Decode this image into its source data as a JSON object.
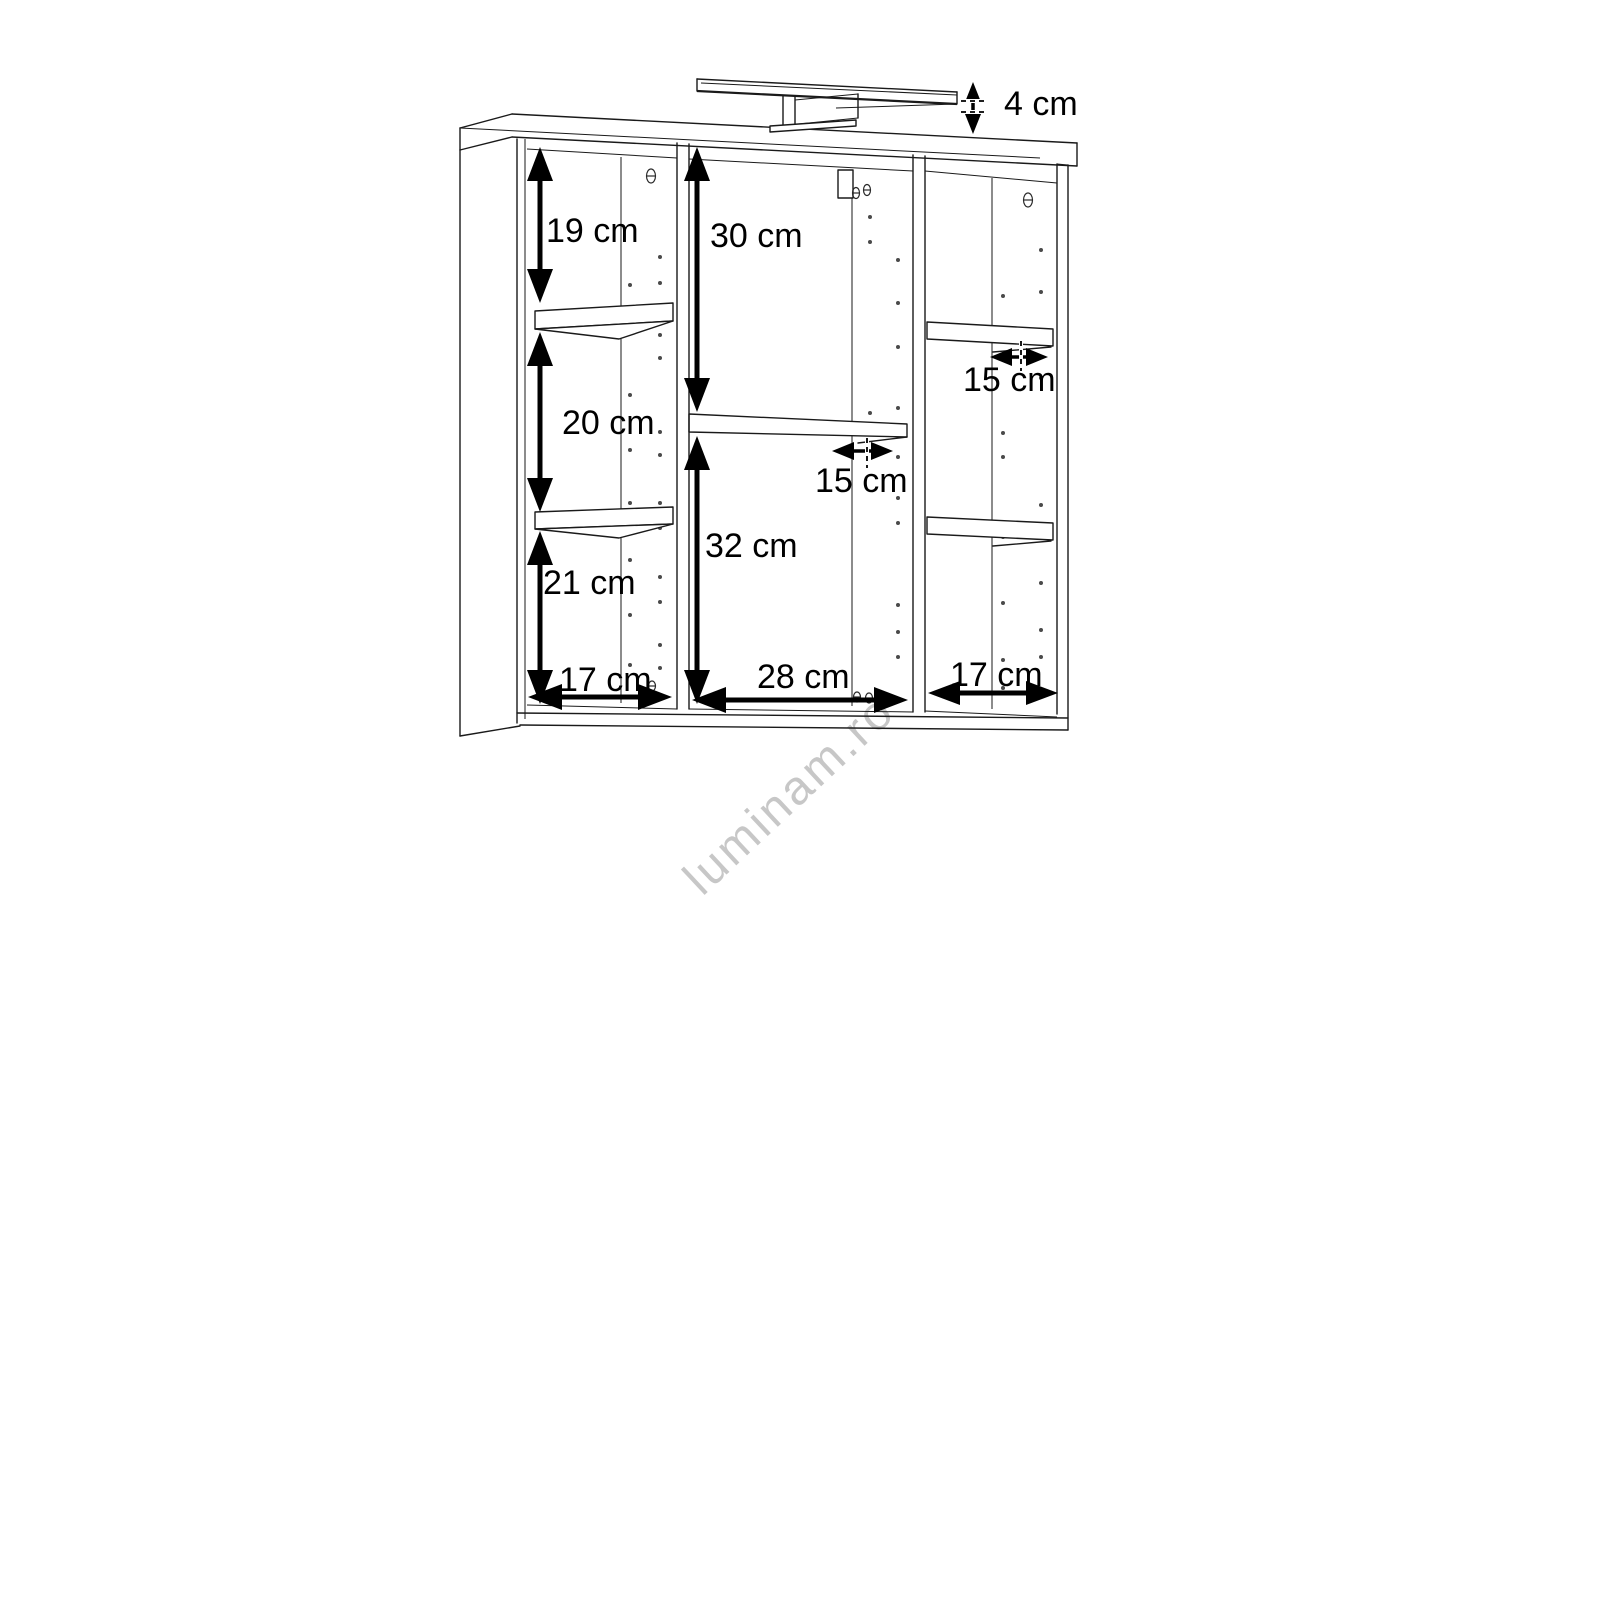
{
  "diagram": {
    "type": "furniture-dimension-drawing",
    "watermark": "luminam.ro",
    "unit": "cm",
    "dimensions": [
      {
        "id": "light-height",
        "label": "4 cm",
        "value": 4,
        "orientation": "vertical",
        "location": "lamp above cabinet top"
      },
      {
        "id": "left-top-height",
        "label": "19 cm",
        "value": 19,
        "orientation": "vertical",
        "location": "left column, top compartment"
      },
      {
        "id": "center-top-height",
        "label": "30 cm",
        "value": 30,
        "orientation": "vertical",
        "location": "center column, above middle shelf"
      },
      {
        "id": "left-middle-height",
        "label": "20 cm",
        "value": 20,
        "orientation": "vertical",
        "location": "left column, middle compartment"
      },
      {
        "id": "right-shelf-depth",
        "label": "15 cm",
        "value": 15,
        "orientation": "horizontal",
        "location": "right column shelf depth"
      },
      {
        "id": "center-shelf-depth",
        "label": "15 cm",
        "value": 15,
        "orientation": "horizontal",
        "location": "center column shelf depth"
      },
      {
        "id": "left-bottom-height",
        "label": "21 cm",
        "value": 21,
        "orientation": "vertical",
        "location": "left column, bottom compartment"
      },
      {
        "id": "center-bottom-height",
        "label": "32 cm",
        "value": 32,
        "orientation": "vertical",
        "location": "center column, below middle shelf"
      },
      {
        "id": "left-width",
        "label": "17 cm",
        "value": 17,
        "orientation": "horizontal",
        "location": "left column width"
      },
      {
        "id": "center-width",
        "label": "28 cm",
        "value": 28,
        "orientation": "horizontal",
        "location": "center column width"
      },
      {
        "id": "right-width",
        "label": "17 cm",
        "value": 17,
        "orientation": "horizontal",
        "location": "right column width"
      }
    ]
  }
}
